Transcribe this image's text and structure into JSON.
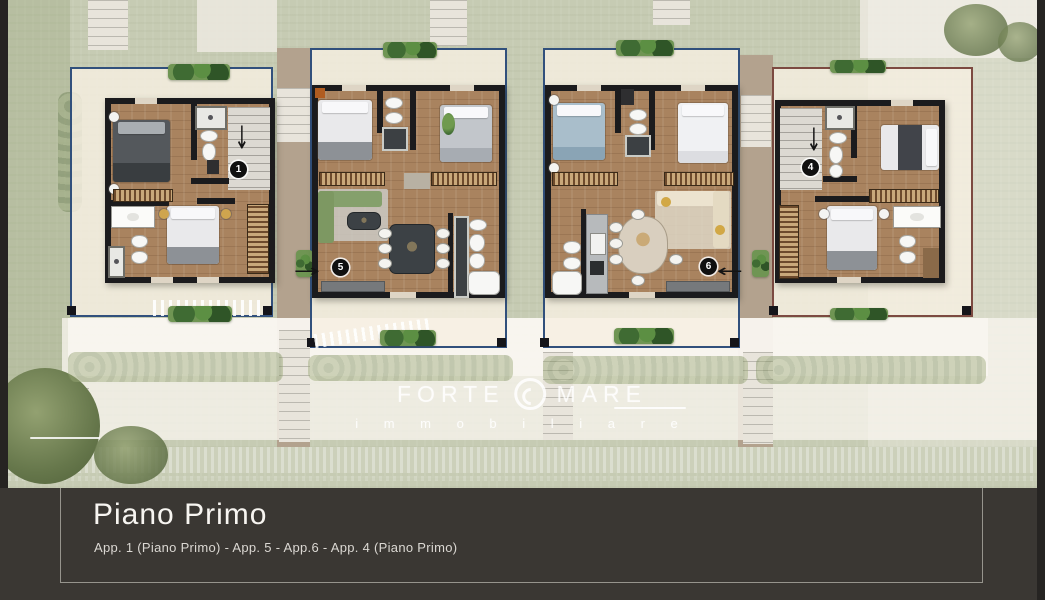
{
  "plan": {
    "watermark": {
      "brand_left": "FORTE",
      "brand_right": "MARE",
      "subtitle": "i m m o b i l i a r e"
    },
    "units": [
      {
        "id": "app-1",
        "number": "1",
        "arrow": "down"
      },
      {
        "id": "app-5",
        "number": "5",
        "arrow": "right"
      },
      {
        "id": "app-6",
        "number": "6",
        "arrow": "left"
      },
      {
        "id": "app-4",
        "number": "4",
        "arrow": "down"
      }
    ],
    "colors": {
      "terrace_border": "#31507c",
      "lawn": "#c6cbb3",
      "wood_floor": "#a9835f",
      "walls": "#1b1b1d"
    }
  },
  "icons": {
    "arrow_down": "↓",
    "arrow_right": "→",
    "arrow_left": "←"
  },
  "footer": {
    "title": "Piano Primo",
    "subtitle": "App. 1 (Piano Primo) - App. 5 - App.6 - App. 4 (Piano Primo)",
    "background": "#3a3733"
  }
}
